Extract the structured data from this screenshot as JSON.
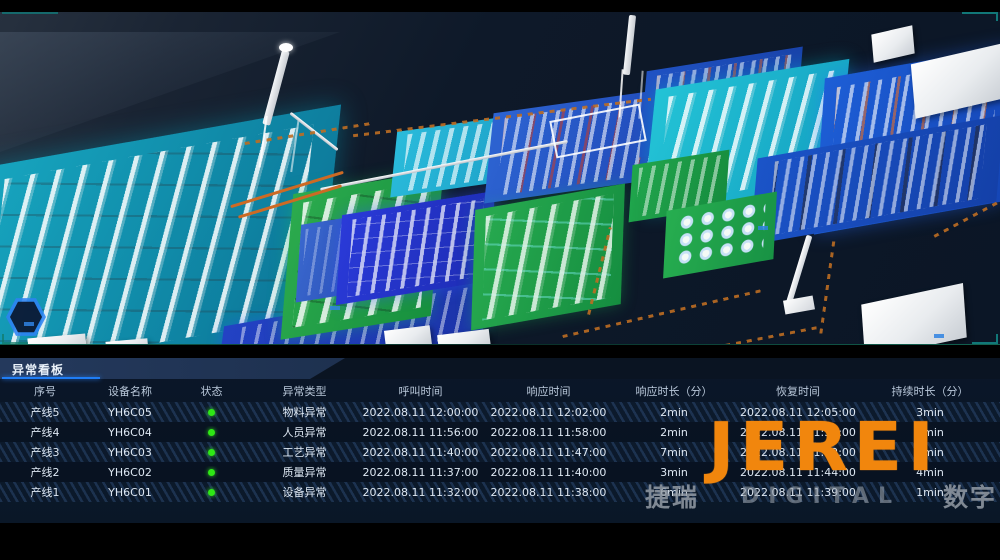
{
  "scene": {
    "description": "3d-factory-digital-twin",
    "colors": {
      "teal_floor": "#14a2bc",
      "green_platform": "#23a64b",
      "royal_blue_platform": "#2336cf",
      "blue_platform": "#1c58d0",
      "cyan_platform": "#25b5d5",
      "conveyor_orange": "#bd6d22",
      "background_navy": "#0c1727"
    }
  },
  "table": {
    "title": "异常看板",
    "accent_underline_color": "#1f7df5",
    "status_dot_color": "#2ee815",
    "columns": [
      {
        "key": "seq",
        "label": "序号"
      },
      {
        "key": "device",
        "label": "设备名称"
      },
      {
        "key": "status",
        "label": "状态"
      },
      {
        "key": "type",
        "label": "异常类型"
      },
      {
        "key": "call",
        "label": "呼叫时间"
      },
      {
        "key": "resp",
        "label": "响应时间"
      },
      {
        "key": "resp_dur",
        "label": "响应时长（分）"
      },
      {
        "key": "recover",
        "label": "恢复时间"
      },
      {
        "key": "dur",
        "label": "持续时长（分）"
      }
    ],
    "rows": [
      {
        "seq": "产线5",
        "device": "YH6C05",
        "status": "green",
        "type": "物料异常",
        "call": "2022.08.11 12:00:00",
        "resp": "2022.08.11 12:02:00",
        "resp_dur": "2min",
        "recover": "2022.08.11 12:05:00",
        "dur": "3min"
      },
      {
        "seq": "产线4",
        "device": "YH6C04",
        "status": "green",
        "type": "人员异常",
        "call": "2022.08.11 11:56:00",
        "resp": "2022.08.11 11:58:00",
        "resp_dur": "2min",
        "recover": "2022.08.11 11:59:00",
        "dur": "3min"
      },
      {
        "seq": "产线3",
        "device": "YH6C03",
        "status": "green",
        "type": "工艺异常",
        "call": "2022.08.11 11:40:00",
        "resp": "2022.08.11 11:47:00",
        "resp_dur": "7min",
        "recover": "2022.08.11 11:52:00",
        "dur": "5min"
      },
      {
        "seq": "产线2",
        "device": "YH6C02",
        "status": "green",
        "type": "质量异常",
        "call": "2022.08.11 11:37:00",
        "resp": "2022.08.11 11:40:00",
        "resp_dur": "3min",
        "recover": "2022.08.11 11:44:00",
        "dur": "4min"
      },
      {
        "seq": "产线1",
        "device": "YH6C01",
        "status": "green",
        "type": "设备异常",
        "call": "2022.08.11 11:32:00",
        "resp": "2022.08.11 11:38:00",
        "resp_dur": "6min",
        "recover": "2022.08.11 11:39:00",
        "dur": "1min"
      }
    ]
  },
  "watermark": {
    "logo": "JEREI",
    "logo_color": "#f1860d",
    "sub_left": "捷瑞",
    "sub_mid": "DIGITAL",
    "sub_right": "数字"
  }
}
